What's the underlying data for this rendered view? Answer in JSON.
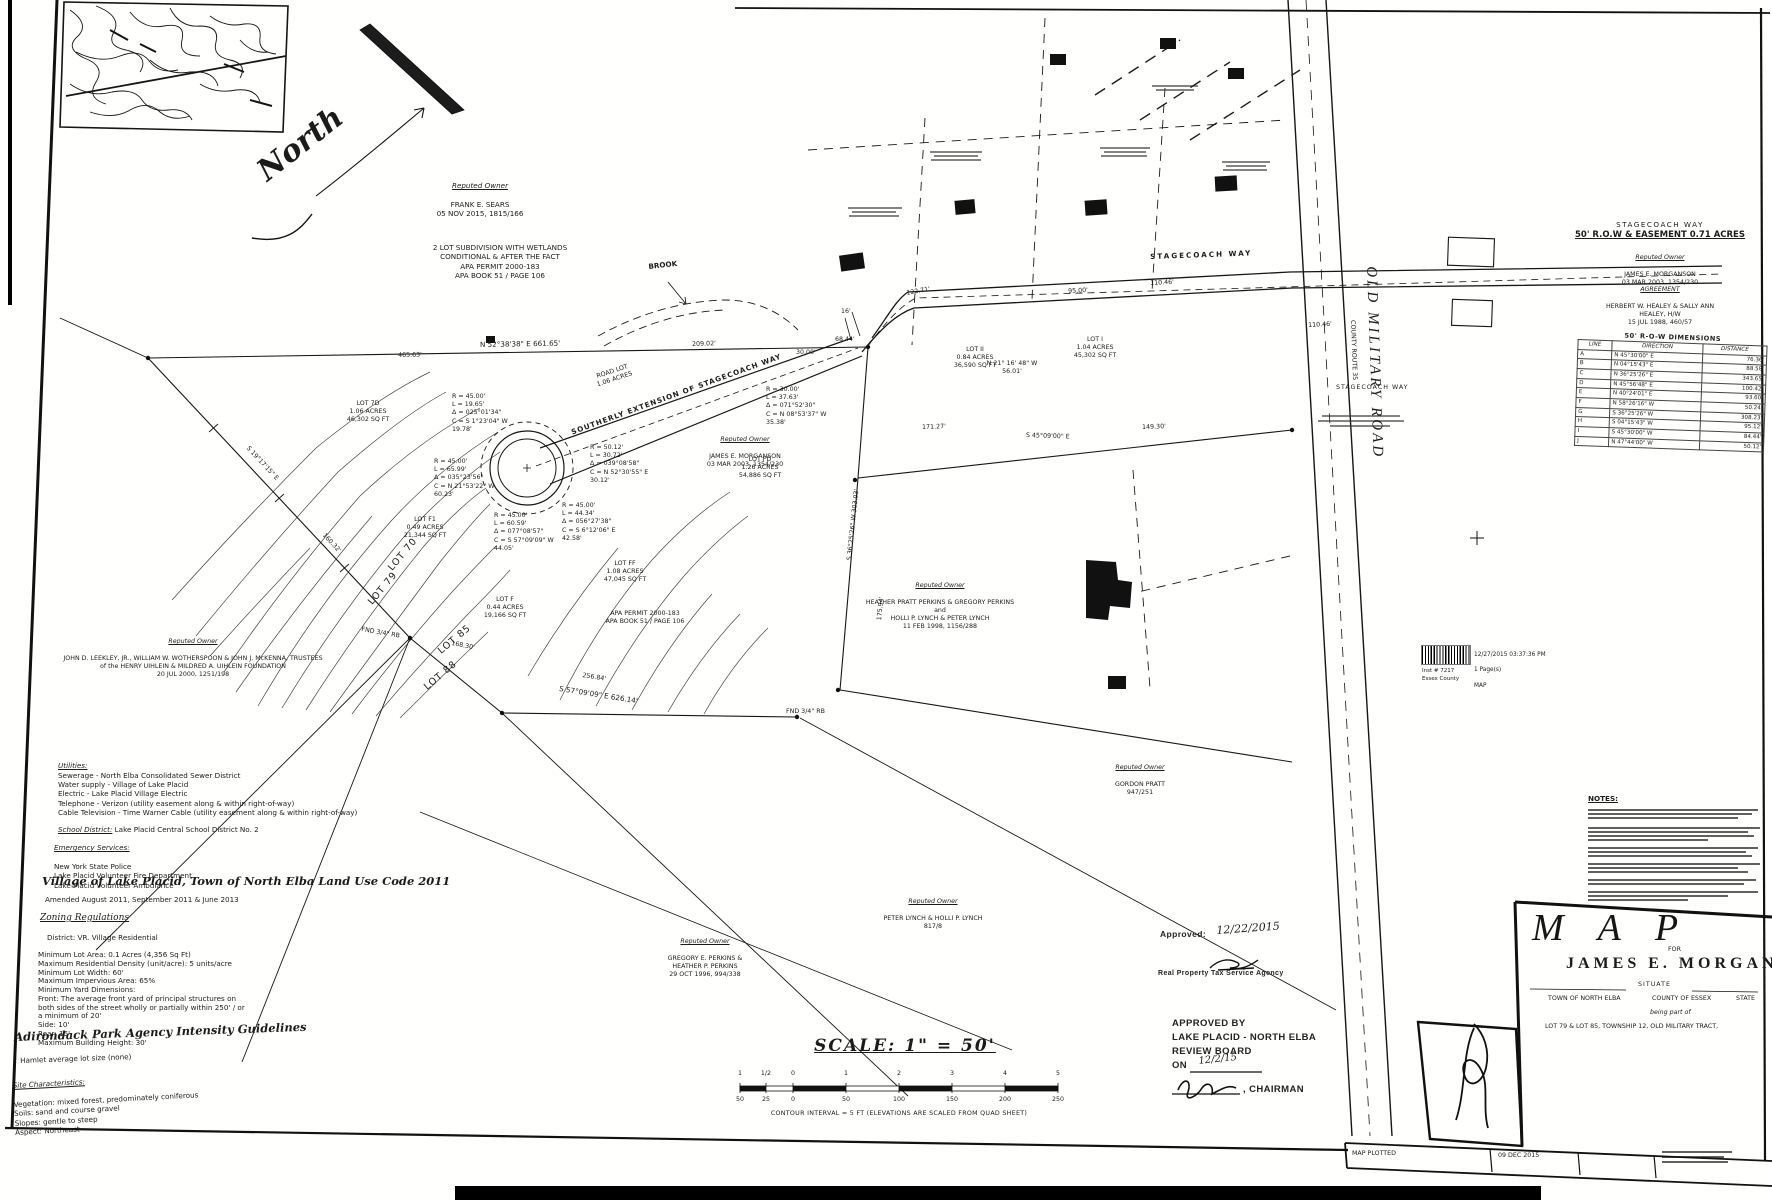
{
  "inset": {
    "north_label": "North"
  },
  "map": {
    "roads": {
      "stagecoach_way": "STAGECOACH WAY",
      "stagecoach_way_east": "STAGECOACH WAY",
      "southerly_extension": "SOUTHERLY EXTENSION OF STAGECOACH WAY",
      "old_military_road": "OLD MILITARY ROAD",
      "county_route": "COUNTY ROUTE 35",
      "road_lot": "ROAD LOT\n1.06 ACRES"
    },
    "features": {
      "brook": "BROOK"
    },
    "notes": {
      "subdivision": "2 LOT SUBDIVISION WITH WETLANDS\nCONDITIONAL & AFTER THE FACT\nAPA PERMIT 2000-183\nAPA BOOK 51 / PAGE 106",
      "apa_permit": "APA PERMIT 2000-183\nAPA BOOK 51 / PAGE 106",
      "row_heading1": "STAGECOACH WAY",
      "row_heading2": "50' R.O.W & EASEMENT  0.71 ACRES"
    },
    "owners": {
      "sears": {
        "heading": "Reputed Owner",
        "body": "FRANK E. SEARS\n05 NOV 2015,   1815/166"
      },
      "uihlein": {
        "heading": "Reputed Owner",
        "body": "JOHN D. LEEKLEY, JR., WILLIAM W. WOTHERSPOON & JOHN J. McKENNA, TRUSTEES\nof the HENRY UIHLEIN & MILDRED A. UIHLEIN FOUNDATION\n20 JUL 2000,   1251/198"
      },
      "morganson": {
        "heading": "Reputed Owner",
        "body": "JAMES E. MORGANSON\n03 MAR 2003,   1354/230"
      },
      "morganson_row": {
        "heading": "Reputed Owner",
        "body": "JAMES E. MORGANSON\n03 MAR 2003,   1354/230"
      },
      "healey": {
        "heading": "AGREEMENT",
        "body": "HERBERT W. HEALEY & SALLY ANN HEALEY, H/W\n15 JUL 1988,   460/57"
      },
      "perkins_lynch": {
        "heading": "Reputed Owner",
        "body": "HEATHER PRATT PERKINS & GREGORY PERKINS\nand\nHOLLI P. LYNCH & PETER LYNCH\n11 FEB 1998,   1156/288"
      },
      "pratt": {
        "heading": "Reputed Owner",
        "body": "GORDON PRATT\n947/251"
      },
      "lynch": {
        "heading": "Reputed Owner",
        "body": "PETER LYNCH & HOLLI P. LYNCH\n817/8"
      },
      "perkins": {
        "heading": "Reputed Owner",
        "body": "GREGORY E. PERKINS &\nHEATHER P. PERKINS\n29 OCT 1996,   994/338"
      }
    },
    "lots": {
      "lot_7d": "LOT 7D\n1.06 ACRES\n46,302 SQ FT",
      "lot_f1": "LOT F1\n0.49 ACRES\n21,344 SQ FT",
      "lot_f": "LOT F\n0.44 ACRES\n19,166 SQ FT",
      "lot_ff": "LOT FF\n1.08 ACRES\n47,045 SQ FT",
      "lot_fd": "LOT FD\n1.26 ACRES\n54,886 SQ FT",
      "lot_ii": "LOT II\n0.84 ACRES\n36,590 SQ FT",
      "lot_i": "LOT I\n1.04 ACRES\n45,302 SQ FT",
      "lot70": "LOT 70",
      "lot79": "LOT 79",
      "lot85": "LOT 85",
      "lot88": "LOT 88"
    },
    "curves": {
      "c1": "R = 45.00'\nL = 19.65'\nΔ = 025°01'34\"\nC = S 1°23'04\" W\n19.78'",
      "c2": "R = 45.00'\nL = 65.99'\nΔ = 035°23'56\"\nC = N 21°53'22\" W\n60.23'",
      "c3": "R = 45.00'\nL = 60.59'\nΔ = 077°08'57\"\nC = S 57°09'09\" W\n44.05'",
      "c4": "R = 45.00'\nL = 44.34'\nΔ = 056°27'38\"\nC = S 6°12'06\" E\n42.58'",
      "c5": "R = 50.12'\nL = 30.72'\nΔ = 039°08'58\"\nC = N 52°30'55\" E\n30.12'",
      "c6": "R = 30.00'\nL = 37.63'\nΔ = 071°52'30\"\nC = N 08°53'37\" W\n35.38'"
    },
    "dims": {
      "top_bearing": "N 52°38'38\" E   661.65'",
      "d465": "465.63'",
      "d209": "209.02'",
      "d30": "30.00'",
      "d68": "68.44'",
      "d122": "122.71'",
      "d95": "95.00'",
      "d110a": "110.46'",
      "d110b": "110.46'",
      "d16": "16'",
      "d171": "171.27'",
      "d149": "149.30'",
      "s45": "S 45°09'00\" E",
      "n21": "N 21° 16' 48\" W\n56.01'",
      "s36": "S 36°25'26\" W   303.03'",
      "d175": "175.94'",
      "s57": "S 57°09'09\" E   626.14'",
      "d256": "256.84'",
      "d168": "168.30'",
      "west_bearing": "S 19°17'15\" E",
      "d160": "160.32'"
    },
    "monuments": {
      "m1": "FND 3/4\" RB",
      "m2": "FND 3/4\" RB"
    }
  },
  "left_notes": {
    "utilities_heading": "Utilities:",
    "utilities_body": "Sewerage  -  North Elba Consolidated Sewer District\nWater supply  -  Village of Lake Placid\nElectric  -  Lake Placid Village Electric\nTelephone  -  Verizon (utility easement along & within right-of-way)\nCable Television  -  Time Warner Cable (utility easement along & within right-of-way)",
    "school_heading": "School District:",
    "school_body": "  Lake Placid Central School District No. 2",
    "emergency_heading": "Emergency Services:",
    "emergency_body": "New York State Police\nLake Placid Volunteer Fire Department\nLake Placid Volunteer Ambulance",
    "landuse_title": "Village of Lake Placid, Town of North Elba Land Use Code 2011",
    "amended": "Amended August 2011, September 2011 & June 2013",
    "zoning_heading": "Zoning Regulations",
    "district": "District:  VR. Village Residential",
    "zoning_body": "Minimum Lot Area: 0.1 Acres (4,356 Sq Ft)\nMaximum Residential Density (unit/acre): 5 units/acre\nMinimum Lot Width: 60'\nMaximum Impervious Area: 65%\nMinimum Yard Dimensions:\nFront: The average front yard of principal structures on\nboth sides of the street wholly or partially within 250' / or\na minimum of 20'\nSide: 10'\nRear: 15'\nMaximum Building Height: 30'",
    "apa_title": "Adirondack Park Agency Intensity Guidelines",
    "hamlet": "Hamlet average lot size (none)",
    "site_heading": "Site Characteristics:",
    "site_body": "Vegetation: mixed forest, predominately coniferous\nSoils: sand and course gravel\nSlopes: gentle to steep\nAspect: Northeast"
  },
  "scale": {
    "title": "SCALE:  1\" = 50'",
    "in_ticks": [
      "1",
      "1/2",
      "0",
      "1",
      "2",
      "3",
      "4",
      "5"
    ],
    "ft_ticks": [
      "50",
      "25",
      "0",
      "50",
      "100",
      "150",
      "200",
      "250"
    ],
    "contour": "CONTOUR INTERVAL = 5 FT (ELEVATIONS ARE SCALED FROM QUAD SHEET)"
  },
  "row_table": {
    "title": "50'  R-O-W  DIMENSIONS",
    "headers": [
      "LINE",
      "DIRECTION",
      "DISTANCE"
    ],
    "rows": [
      {
        "line": "A",
        "direction": "N 45°30'00\" E",
        "distance": "76.36'"
      },
      {
        "line": "B",
        "direction": "N 04°15'43\" E",
        "distance": "88.58'"
      },
      {
        "line": "C",
        "direction": "N 36°25'26\" E",
        "distance": "343.65'"
      },
      {
        "line": "D",
        "direction": "N 45°56'48\" E",
        "distance": "100.42'"
      },
      {
        "line": "E",
        "direction": "N 40°24'01\" E",
        "distance": "93.60'"
      },
      {
        "line": "F",
        "direction": "N 58°26'16\" W",
        "distance": "50.24'"
      },
      {
        "line": "G",
        "direction": "S 36°25'26\" W",
        "distance": "308.23'"
      },
      {
        "line": "H",
        "direction": "S 04°15'43\" W",
        "distance": "95.12'"
      },
      {
        "line": "I",
        "direction": "S 45°30'00\" W",
        "distance": "84.44'"
      },
      {
        "line": "J",
        "direction": "N 47°44'00\" W",
        "distance": "50.12'"
      }
    ]
  },
  "approvals": {
    "tax_label": "Approved:",
    "tax_date": "12/22/2015",
    "tax_agency": "Real Property Tax Service Agency",
    "board_line1": "APPROVED BY",
    "board_line2": "LAKE PLACID - NORTH ELBA",
    "board_line3": "REVIEW BOARD",
    "on_label": "ON",
    "on_date": "12/2/15",
    "chairman_label": ", CHAIRMAN"
  },
  "recorder": {
    "datetime": "12/27/2015 03:37:36 PM",
    "pages": "1 Page(s)",
    "doc_type": "MAP",
    "inst": "Inst # 7217",
    "county": "Essex County"
  },
  "title_block": {
    "notes_heading": "NOTES:",
    "map_word": "MAP",
    "for_label": "FOR",
    "client": "JAMES E. MORGANSON",
    "situate": "SITUATE",
    "town": "TOWN OF NORTH ELBA",
    "county": "COUNTY OF ESSEX",
    "state": "STATE",
    "being": "being part of",
    "lots_line": "LOT 79 & LOT 85,   TOWNSHIP 12,   OLD MILITARY TRACT,",
    "plotted_label": "MAP PLOTTED",
    "plotted_date": "09 DEC 2015"
  }
}
